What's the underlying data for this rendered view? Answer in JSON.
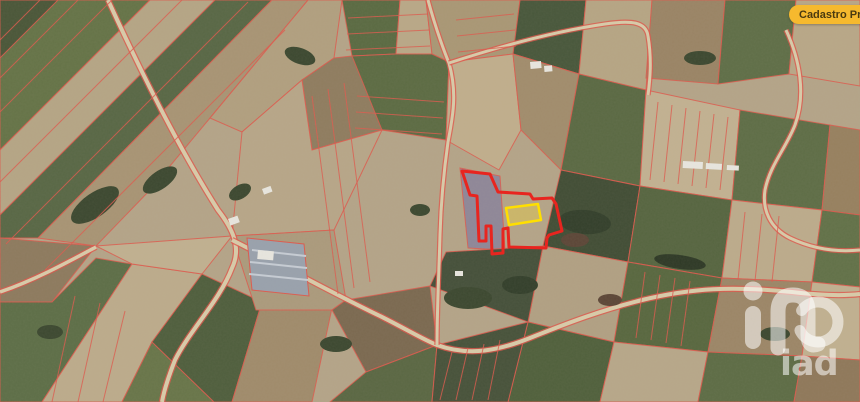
{
  "ui": {
    "badge": {
      "label": "Cadastro Predial",
      "bg": "#F6B92E",
      "fg": "#4A3A10"
    },
    "watermark": {
      "text": "iad",
      "color": "rgba(255,255,255,0.55)"
    }
  },
  "map": {
    "base_color": "#B4A488",
    "cadastral_line_color": "#DD5A4E",
    "road_fill_color": "#D8CBA9",
    "road_edge_color": "#E0564B",
    "building_color": "#E8E6DF",
    "selection": {
      "boundary_color": "#E8251F",
      "boundary_width": 3,
      "boundary_points": "462,171 490,174 498,192 530,194 533,199 552,198 556,204 562,231 549,235 547,238 546,248 509,247 508,228 503,229 503,253 492,254 491,226 486,226 486,241 479,241 477,196 470,195",
      "parcel_stroke": "#FFDF00",
      "parcel_width": 2.5,
      "parcel_fill": "rgba(255,223,41,0.30)",
      "parcel_points": "506,208 538,204 541,220 509,225"
    },
    "fields": [
      {
        "p": "0,0 58,0 30,42 0,58",
        "c": "#4A5638"
      },
      {
        "p": "58,0 150,0 0,150 0,58",
        "c": "#657347"
      },
      {
        "p": "150,0 215,0 0,215 0,150",
        "c": "#B5A585"
      },
      {
        "p": "215,0 272,0 38,238 0,238 0,215",
        "c": "#586745"
      },
      {
        "p": "272,0 308,0 210,118 150,190 96,246 38,238",
        "c": "#A89474"
      },
      {
        "p": "0,238 96,246 52,302 0,302",
        "c": "#8D7A5E"
      },
      {
        "p": "0,302 52,302 96,258 132,264 42,402 0,402",
        "c": "#5D6E47"
      },
      {
        "p": "42,402 132,264 202,274 152,342 122,402",
        "c": "#BCAB8B"
      },
      {
        "p": "122,402 152,342 214,402",
        "c": "#687549"
      },
      {
        "p": "96,246 232,236 202,274 132,264",
        "c": "#C0B090"
      },
      {
        "p": "152,342 202,274 262,302 232,402 214,402",
        "c": "#4F5E3D"
      },
      {
        "p": "232,402 262,302 332,308 312,402",
        "c": "#A08B6B"
      },
      {
        "p": "308,0 342,0 334,58 302,80 242,132 210,118",
        "c": "#B19F7F"
      },
      {
        "p": "302,80 334,58 352,56 390,60 382,130 312,150",
        "c": "#8F7C5F"
      },
      {
        "p": "312,150 382,130 362,172 334,230 232,236 242,132 302,80",
        "c": "#B7A688"
      },
      {
        "p": "232,236 334,230 346,300 332,310 256,310",
        "c": "#AB9A7C"
      },
      {
        "p": "342,0 400,0 396,54 352,56",
        "c": "#5A6A42"
      },
      {
        "p": "400,0 426,0 432,54 396,54",
        "c": "#B9A887"
      },
      {
        "p": "426,0 520,0 513,54 449,62 432,54",
        "c": "#A99775"
      },
      {
        "p": "352,56 396,54 432,54 449,62 446,140 382,130",
        "c": "#5C6B43"
      },
      {
        "p": "520,0 586,0 579,74 513,54",
        "c": "#48573B"
      },
      {
        "p": "586,0 652,0 646,90 579,74",
        "c": "#B6A584"
      },
      {
        "p": "449,62 513,54 521,130 499,170 446,140",
        "c": "#C0AE8C"
      },
      {
        "p": "513,54 579,74 561,170 521,130",
        "c": "#A18C6C"
      },
      {
        "p": "460,168 500,176 505,250 468,248",
        "c": "#8F8798"
      },
      {
        "p": "579,74 646,90 640,186 561,170",
        "c": "#5A6943"
      },
      {
        "p": "646,90 740,110 732,200 640,186",
        "c": "#C2B191"
      },
      {
        "p": "740,110 830,125 822,210 732,200",
        "c": "#5E6D46"
      },
      {
        "p": "830,125 860,130 860,215 822,210",
        "c": "#97805F"
      },
      {
        "p": "561,170 640,186 628,262 543,246",
        "c": "#414D35"
      },
      {
        "p": "640,186 732,200 722,278 628,262",
        "c": "#566540"
      },
      {
        "p": "732,200 822,210 812,282 722,278",
        "c": "#BCAB8B"
      },
      {
        "p": "822,210 860,215 860,287 812,282",
        "c": "#627148"
      },
      {
        "p": "543,246 628,262 614,342 528,322",
        "c": "#B1A083"
      },
      {
        "p": "628,262 722,278 708,352 614,342",
        "c": "#58673F"
      },
      {
        "p": "722,278 812,282 802,356 708,352",
        "c": "#9C8667"
      },
      {
        "p": "812,282 860,287 860,360 802,356",
        "c": "#C0B090"
      },
      {
        "p": "528,322 614,342 600,402 508,402",
        "c": "#50603C"
      },
      {
        "p": "614,342 708,352 698,402 600,402",
        "c": "#B7A789"
      },
      {
        "p": "708,352 802,356 794,402 698,402",
        "c": "#5D6C45"
      },
      {
        "p": "802,356 860,360 860,402 794,402",
        "c": "#8F785A"
      },
      {
        "p": "652,0 725,0 718,84 646,78",
        "c": "#9A8465"
      },
      {
        "p": "725,0 796,0 789,74 718,84",
        "c": "#5F6E47"
      },
      {
        "p": "796,0 860,0 860,86 789,74",
        "c": "#B8A787"
      },
      {
        "p": "346,300 430,286 437,345 366,372 332,310",
        "c": "#7B6950"
      },
      {
        "p": "366,372 437,345 432,402 330,402",
        "c": "#5A6743"
      },
      {
        "p": "437,345 528,322 508,402 432,402",
        "c": "#47523A"
      },
      {
        "p": "446,252 543,246 528,322 430,286",
        "c": "#45503A"
      }
    ],
    "strip_lines": [
      [
        40,
        0,
        0,
        40
      ],
      [
        78,
        0,
        0,
        78
      ],
      [
        112,
        0,
        0,
        112
      ],
      [
        182,
        0,
        0,
        182
      ],
      [
        248,
        2,
        6,
        244
      ],
      [
        285,
        30,
        45,
        270
      ],
      [
        75,
        296,
        52,
        402
      ],
      [
        100,
        303,
        78,
        402
      ],
      [
        125,
        311,
        103,
        402
      ],
      [
        348,
        18,
        428,
        14
      ],
      [
        347,
        34,
        429,
        30
      ],
      [
        346,
        50,
        430,
        46
      ],
      [
        357,
        96,
        444,
        102
      ],
      [
        356,
        112,
        443,
        118
      ],
      [
        355,
        128,
        442,
        134
      ],
      [
        456,
        20,
        514,
        14
      ],
      [
        457,
        36,
        515,
        30
      ],
      [
        458,
        52,
        516,
        46
      ],
      [
        312,
        96,
        338,
        294
      ],
      [
        328,
        89,
        354,
        288
      ],
      [
        344,
        83,
        370,
        282
      ],
      [
        658,
        102,
        650,
        180
      ],
      [
        672,
        105,
        664,
        182
      ],
      [
        686,
        108,
        678,
        184
      ],
      [
        700,
        111,
        692,
        186
      ],
      [
        714,
        114,
        706,
        188
      ],
      [
        728,
        117,
        720,
        190
      ],
      [
        645,
        272,
        636,
        338
      ],
      [
        660,
        275,
        651,
        340
      ],
      [
        675,
        278,
        666,
        343
      ],
      [
        690,
        281,
        681,
        346
      ],
      [
        745,
        212,
        738,
        280
      ],
      [
        762,
        214,
        755,
        281
      ],
      [
        779,
        216,
        772,
        282
      ],
      [
        452,
        352,
        440,
        400
      ],
      [
        468,
        348,
        456,
        400
      ],
      [
        484,
        344,
        472,
        400
      ],
      [
        500,
        340,
        488,
        400
      ]
    ],
    "roads": [
      {
        "d": "M108,0 C140,70 180,150 218,210 C232,228 242,247 232,268 C220,300 190,330 175,360 C168,378 164,390 162,402",
        "w": 4
      },
      {
        "d": "M232,240 C280,264 330,292 380,316 C408,330 424,340 437,345 C470,357 500,350 530,338 C570,322 602,310 642,300 C692,288 732,286 792,292 C818,295 842,296 860,294",
        "w": 4
      },
      {
        "d": "M428,0 C436,30 446,56 449,63 C458,95 452,120 448,142 C444,170 441,200 440,235 C439,272 437,310 437,345",
        "w": 3
      },
      {
        "d": "M449,63 C495,48 550,32 605,24 C632,20 646,22 648,36 C652,60 650,80 648,95",
        "w": 3
      },
      {
        "d": "M786,30 C800,60 806,95 795,125 C786,148 770,165 765,190 C762,210 770,228 790,238 C815,250 840,252 860,250",
        "w": 3
      },
      {
        "d": "M0,292 C35,280 68,262 96,247",
        "w": 3.5
      }
    ],
    "woods": [
      {
        "e": [
          95,
          205,
          28,
          12,
          -35
        ],
        "c": "#3C4830"
      },
      {
        "e": [
          160,
          180,
          20,
          9,
          -35
        ],
        "c": "#3C4830"
      },
      {
        "e": [
          300,
          56,
          16,
          8,
          20
        ],
        "c": "#3C4830"
      },
      {
        "e": [
          585,
          222,
          26,
          12,
          5
        ],
        "c": "#333F2B"
      },
      {
        "e": [
          468,
          298,
          24,
          11,
          0
        ],
        "c": "#3C4830"
      },
      {
        "e": [
          240,
          192,
          12,
          7,
          -30
        ],
        "c": "#3C4830"
      },
      {
        "e": [
          700,
          58,
          16,
          7,
          0
        ],
        "c": "#3C4830"
      },
      {
        "e": [
          50,
          332,
          13,
          7,
          0
        ],
        "c": "#3C4830"
      },
      {
        "e": [
          775,
          334,
          15,
          7,
          0
        ],
        "c": "#3C4830"
      },
      {
        "e": [
          336,
          344,
          16,
          8,
          0
        ],
        "c": "#3C4830"
      },
      {
        "e": [
          520,
          285,
          18,
          9,
          0
        ],
        "c": "#333F2B"
      },
      {
        "e": [
          420,
          210,
          10,
          6,
          0
        ],
        "c": "#3C4830"
      },
      {
        "e": [
          575,
          240,
          14,
          7,
          0
        ],
        "c": "#5C4637"
      },
      {
        "e": [
          610,
          300,
          12,
          6,
          0
        ],
        "c": "#5C4637"
      },
      {
        "e": [
          680,
          262,
          26,
          7,
          8
        ],
        "c": "#2E3926"
      }
    ],
    "greenhouse": {
      "p": "247,238 304,244 309,296 252,290",
      "c": "#99A1AC",
      "stripes": [
        [
          252,
          250,
          306,
          256
        ],
        [
          250,
          262,
          307,
          268
        ],
        [
          249,
          274,
          308,
          280
        ]
      ],
      "stripe_color": "#C6CCD4"
    },
    "buildings": [
      {
        "x": 530,
        "y": 62,
        "w": 11,
        "h": 7,
        "r": -5
      },
      {
        "x": 544,
        "y": 66,
        "w": 8,
        "h": 6,
        "r": -5
      },
      {
        "x": 683,
        "y": 161,
        "w": 20,
        "h": 7,
        "r": 3
      },
      {
        "x": 706,
        "y": 163,
        "w": 16,
        "h": 6,
        "r": 3
      },
      {
        "x": 727,
        "y": 165,
        "w": 12,
        "h": 5,
        "r": 3
      },
      {
        "x": 262,
        "y": 189,
        "w": 9,
        "h": 6,
        "r": -20
      },
      {
        "x": 455,
        "y": 271,
        "w": 8,
        "h": 5,
        "r": 0
      },
      {
        "x": 228,
        "y": 219,
        "w": 10,
        "h": 7,
        "r": -20
      },
      {
        "x": 258,
        "y": 250,
        "w": 16,
        "h": 9,
        "r": 5
      }
    ]
  }
}
